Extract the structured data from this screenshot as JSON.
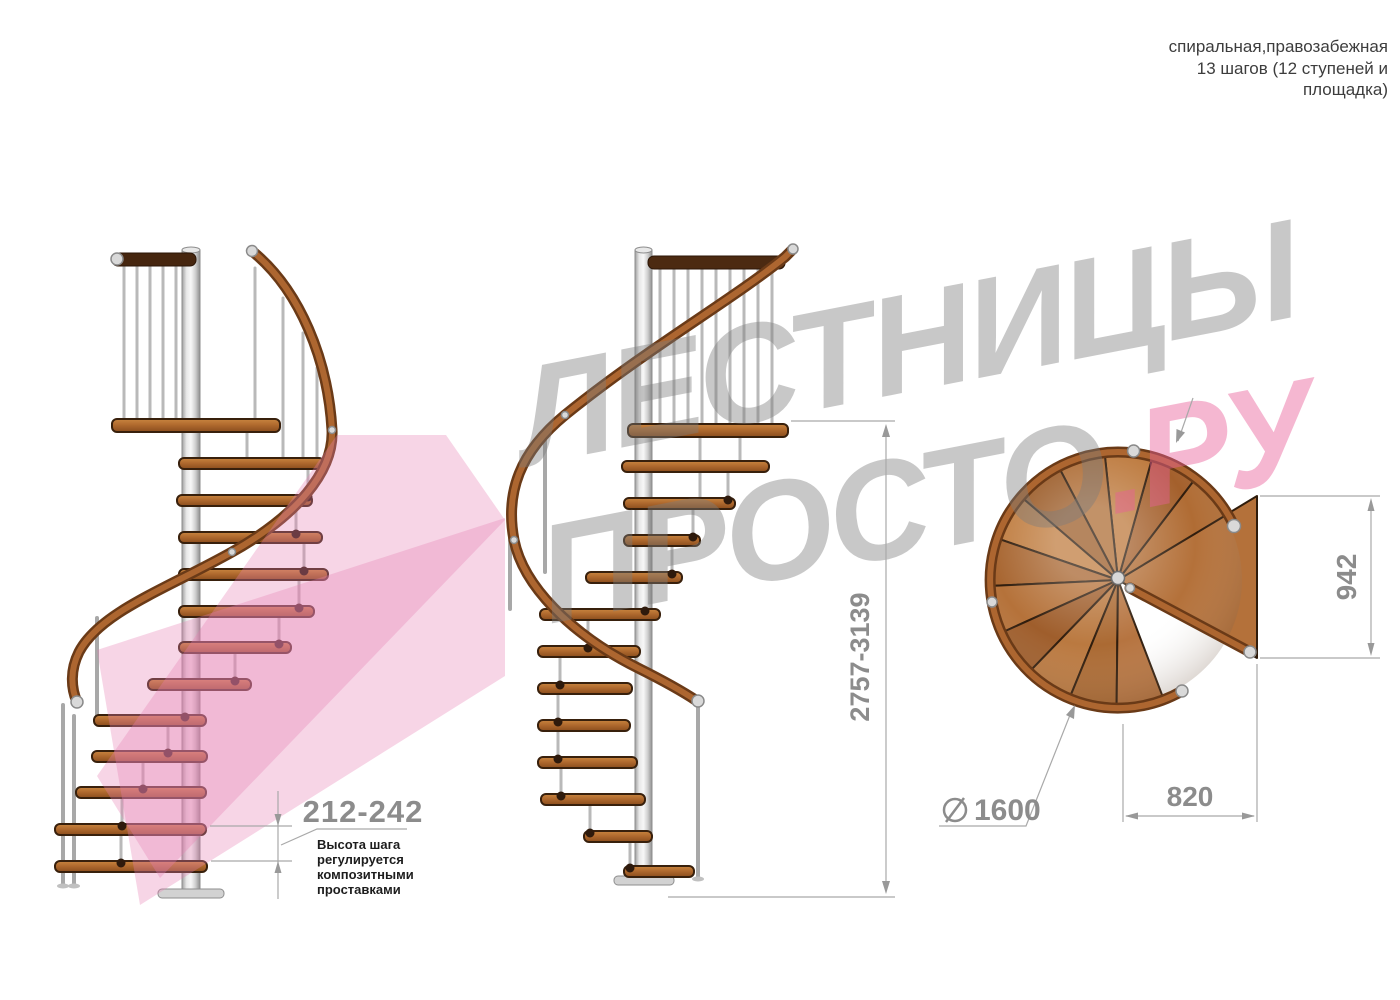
{
  "header": {
    "line1": "спиральная,правозабежная",
    "line2": "13 шагов (12 ступеней и",
    "line3": "площадка)"
  },
  "watermark": {
    "line1": "ЛЕСТНИЦЫ",
    "line2_gray": "ПРОСТО",
    "line2_pink": ".РУ",
    "gray_color": "#cdcdcd",
    "pink_color": "#f2b4d0"
  },
  "dimensions": {
    "step_height": "212-242",
    "step_height_note_lines": [
      "Высота шага",
      "регулируется",
      "композитными",
      "проставками"
    ],
    "total_height": "2757-3139",
    "platform_width": "942",
    "platform_depth": "820",
    "diameter": "1600"
  },
  "colors": {
    "wood": "#b4713a",
    "rail_dark": "#6a3a17",
    "steel": "#d9d9d9",
    "dimension_gray": "#9a9a9a",
    "wood_shades": [
      "#b06c34",
      "#a4602c",
      "#bd7a3e",
      "#ae6d36",
      "#9c5d2a",
      "#c07e42",
      "#a86631",
      "#b5723a",
      "#9f5e2c",
      "#ba7940",
      "#ab6a33",
      "#b67440"
    ]
  }
}
